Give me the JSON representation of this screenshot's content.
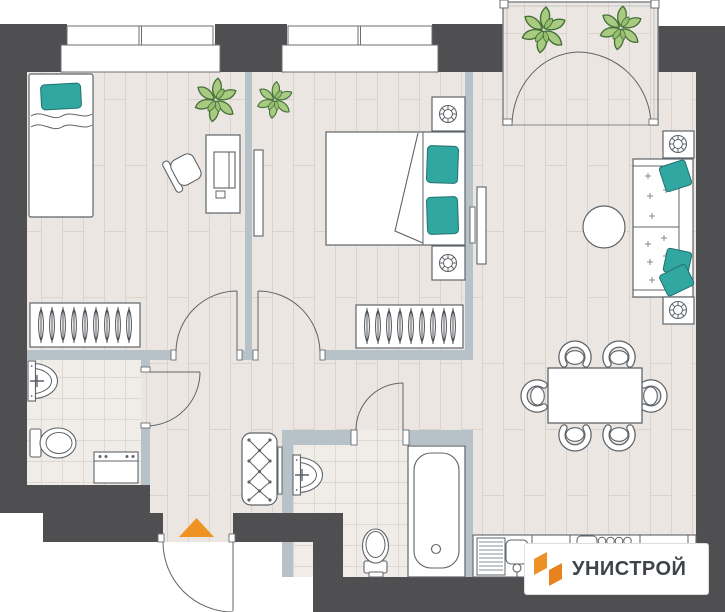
{
  "logo": {
    "text": "УНИСТРОЙ"
  },
  "colors": {
    "exterior_wall": "#4F4F51",
    "interior_wall": "#B6C1C8",
    "floor_plank": "#EBE6E1",
    "tile": "#F0EDE9",
    "outline": "#5F6469",
    "accent_teal": "#31A7A2",
    "accent_orange": "#ED9127",
    "plant_green": "#A9CB81"
  },
  "plan": {
    "rooms": [
      {
        "name": "bedroom-1",
        "furniture": [
          "single-bed",
          "teal-pillow",
          "desk",
          "desk-chair",
          "monitor",
          "plant",
          "hanger-wardrobe"
        ]
      },
      {
        "name": "bedroom-2",
        "furniture": [
          "double-bed",
          "teal-pillow",
          "teal-pillow",
          "nightstand",
          "nightstand",
          "wall-tv",
          "plant",
          "hanger-wardrobe"
        ]
      },
      {
        "name": "balcony",
        "furniture": [
          "plant",
          "plant",
          "french-doors"
        ]
      },
      {
        "name": "living-dining",
        "furniture": [
          "sofa",
          "teal-cushions",
          "round-coffee-table",
          "side-table",
          "side-table",
          "wall-tv",
          "dining-table",
          "chair",
          "chair",
          "chair",
          "chair",
          "chair",
          "chair"
        ]
      },
      {
        "name": "kitchen",
        "furniture": [
          "counter",
          "dish-drainer",
          "sink",
          "cooktop-4-burners"
        ]
      },
      {
        "name": "bathroom-1",
        "furniture": [
          "wash-basin",
          "toilet",
          "washing-machine"
        ]
      },
      {
        "name": "bathroom-2",
        "furniture": [
          "wash-basin",
          "toilet",
          "bathtub"
        ]
      },
      {
        "name": "hallway",
        "furniture": [
          "tufted-bench",
          "entrance-arrow"
        ]
      }
    ]
  }
}
